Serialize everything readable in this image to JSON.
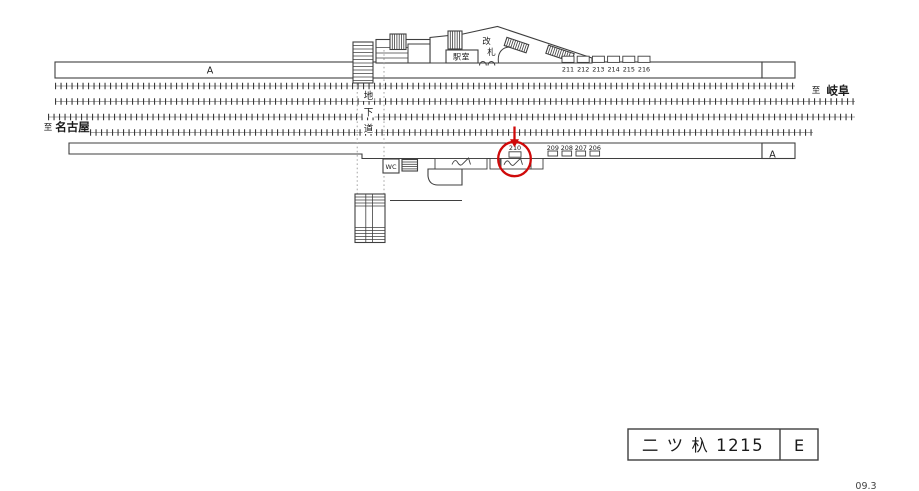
{
  "diagram": {
    "colors": {
      "line": "#3f3f3f",
      "track": "#3a3a3a",
      "dotted": "#9a9a9a",
      "highlight": "#cf0a0a",
      "text": "#1a1a1a"
    },
    "directions": {
      "right": {
        "prefix": "至",
        "name": "岐阜"
      },
      "left": {
        "prefix": "至",
        "name": "名古屋"
      }
    },
    "underpass_chars": [
      "地",
      "下",
      "道"
    ],
    "station_room_label": "駅室",
    "gate_chars": [
      "改",
      "札"
    ],
    "wc_label": "WC",
    "shelter_mark": "A",
    "top_platform_boards": [
      "211",
      "212",
      "213",
      "214",
      "215",
      "216"
    ],
    "bottom_platform_boards": [
      "209",
      "208",
      "207",
      "206"
    ],
    "highlighted_board": "210",
    "title_box": {
      "name": "二 ツ 杁 1215",
      "code": "E"
    },
    "edition": "09.3"
  }
}
